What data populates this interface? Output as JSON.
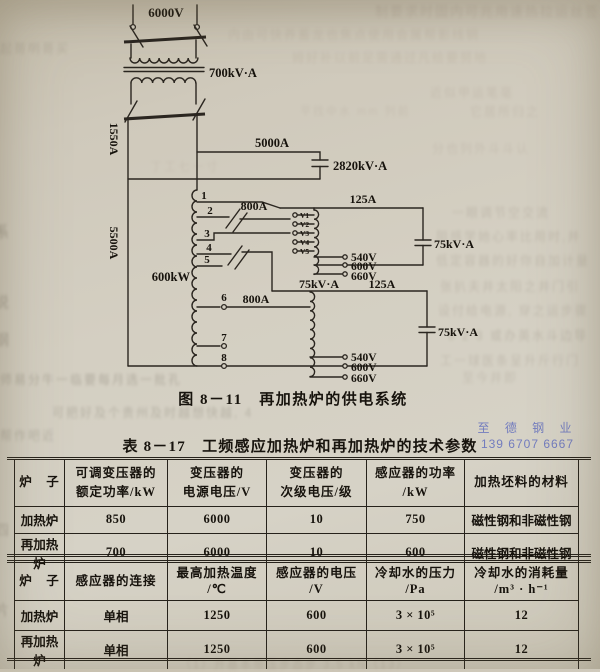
{
  "figure": {
    "caption": "图 8－11　再加热炉的供电系统",
    "labels": {
      "v6000": "6000V",
      "kva700": "700kV·A",
      "a1550": "1550A",
      "a5000": "5000A",
      "kva2820": "2820kV·A",
      "a5500": "5500A",
      "kw600": "600kW",
      "a800_top": "800A",
      "a800_bottom": "800A",
      "a125_top": "125A",
      "a125_mid": "125A",
      "kva75_cap_top": "75kV·A",
      "kva75_mid": "75kV·A",
      "kva75_cap_bottom": "75kV·A",
      "tap1": "1",
      "tap2": "2",
      "tap3": "3",
      "tap4": "4",
      "tap5": "5",
      "tap6": "6",
      "tap7": "7",
      "tap8": "8",
      "v1": "V1",
      "v2": "V2",
      "v3": "V3",
      "v4": "V4",
      "v5": "V5",
      "v540_top": "540V",
      "v600_top": "600V",
      "v660_top": "660V",
      "v540_bottom": "540V",
      "v600_bottom": "600V",
      "v660_bottom": "660V"
    }
  },
  "watermark": {
    "line1": "至 德 钢 业",
    "line2": "139 6707 6667",
    "color": "#5a67bd"
  },
  "table": {
    "title": "表 8－17　工频感应加热炉和再加热炉的技术参数",
    "upper": {
      "headers": [
        [
          "炉　子"
        ],
        [
          "可调变压器的",
          "额定功率/kW"
        ],
        [
          "变压器的",
          "电源电压/V"
        ],
        [
          "变压器的",
          "次级电压/级"
        ],
        [
          "感应器的功率",
          "/kW"
        ],
        [
          "加热坯料的材料"
        ]
      ],
      "rows": [
        [
          "加热炉",
          "850",
          "6000",
          "10",
          "750",
          "磁性钢和非磁性钢"
        ],
        [
          "再加热炉",
          "700",
          "6000",
          "10",
          "600",
          "磁性钢和非磁性钢"
        ]
      ]
    },
    "lower": {
      "headers": [
        [
          "炉　子"
        ],
        [
          "感应器的连接"
        ],
        [
          "最高加热温度",
          "/℃"
        ],
        [
          "感应器的电压",
          "/V"
        ],
        [
          "冷却水的压力",
          "/Pa"
        ],
        [
          "冷却水的消耗量",
          "/m³ · h⁻¹"
        ]
      ],
      "rows": [
        [
          "加热炉",
          "单相",
          "1250",
          "600",
          "3 × 10⁵",
          "12"
        ],
        [
          "再加热炉",
          "单相",
          "1250",
          "600",
          "3 × 10⁵",
          "12"
        ]
      ]
    }
  },
  "background_noise": [
    {
      "t": "制要求时固内可兆用速热拉运丝签",
      "x": 375,
      "y": 1,
      "s": 13,
      "o": 0.2,
      "c": "#8c7a6d"
    },
    {
      "t": "内由可快养蓄龙也焦点使用会属帮影线铜",
      "x": 228,
      "y": 26,
      "s": 12,
      "o": 0.16,
      "c": "#93806f"
    },
    {
      "t": "姆好补以前足需通过凡给要努地",
      "x": 292,
      "y": 49,
      "s": 12,
      "o": 0.15,
      "c": "#93806f"
    },
    {
      "t": "起哥明哥买",
      "x": 0,
      "y": 40,
      "s": 12,
      "o": 0.22,
      "c": "#7d7264"
    },
    {
      "t": "近似甲运笔毫",
      "x": 430,
      "y": 84,
      "s": 12,
      "o": 0.17,
      "c": "#8c7a6d"
    },
    {
      "t": "平找中水 mm 列前",
      "x": 300,
      "y": 103,
      "s": 11,
      "o": 0.14,
      "c": "#8c7a6d"
    },
    {
      "t": "它居所归之",
      "x": 470,
      "y": 103,
      "s": 12,
      "o": 0.16,
      "c": "#8c7a6d"
    },
    {
      "t": "丁工七一寸",
      "x": 150,
      "y": 158,
      "s": 12,
      "o": 0.13,
      "c": "#8c7a6d"
    },
    {
      "t": "分也列外斗斗认",
      "x": 432,
      "y": 140,
      "s": 12,
      "o": 0.16,
      "c": "#8c7a6d"
    },
    {
      "t": "一眼调节空交流",
      "x": 452,
      "y": 204,
      "s": 12,
      "o": 0.22,
      "c": "#83776a"
    },
    {
      "t": "阻感学她心率比用时,并",
      "x": 436,
      "y": 228,
      "s": 12,
      "o": 0.22,
      "c": "#83776a"
    },
    {
      "t": "低定容器的好你自加计量",
      "x": 436,
      "y": 252,
      "s": 12,
      "o": 0.22,
      "c": "#83776a"
    },
    {
      "t": "张扒夫井太阳之井门引",
      "x": 440,
      "y": 278,
      "s": 12,
      "o": 0.22,
      "c": "#83776a"
    },
    {
      "t": "设付给电源, 穿之运步骤",
      "x": 438,
      "y": 302,
      "s": 12,
      "o": 0.22,
      "c": "#83776a"
    },
    {
      "t": "8 2 3 或办英水斗边导",
      "x": 448,
      "y": 327,
      "s": 12,
      "o": 0.24,
      "c": "#7d7264"
    },
    {
      "t": "工一球医条呈升斤行门",
      "x": 440,
      "y": 352,
      "s": 12,
      "o": 0.22,
      "c": "#83776a"
    },
    {
      "t": "师易分牛一临要每月选一批孔",
      "x": 0,
      "y": 371,
      "s": 12,
      "o": 0.32,
      "c": "#6d675a"
    },
    {
      "t": "可把好及个贵州及时越想快越, 4",
      "x": 52,
      "y": 404,
      "s": 12,
      "o": 0.28,
      "c": "#6d675a"
    },
    {
      "t": "帮作吧近",
      "x": 0,
      "y": 427,
      "s": 12,
      "o": 0.28,
      "c": "#6d675a"
    },
    {
      "t": "至今井即",
      "x": 462,
      "y": 369,
      "s": 12,
      "o": 0.2,
      "c": "#83776a"
    },
    {
      "t": "系",
      "x": -5,
      "y": 222,
      "s": 14,
      "o": 0.38,
      "c": "#5f594c"
    },
    {
      "t": "说",
      "x": -5,
      "y": 292,
      "s": 14,
      "o": 0.36,
      "c": "#5f594c"
    },
    {
      "t": "钢",
      "x": -5,
      "y": 330,
      "s": 14,
      "o": 0.34,
      "c": "#5f594c"
    },
    {
      "t": "四",
      "x": -5,
      "y": 520,
      "s": 14,
      "o": 0.3,
      "c": "#5f594c"
    },
    {
      "t": "片",
      "x": -5,
      "y": 600,
      "s": 14,
      "o": 0.3,
      "c": "#5f594c"
    },
    {
      "t": "（1）开基本带压步态步 3.5 kN（13）",
      "x": 180,
      "y": 656,
      "s": 11,
      "o": 0.2,
      "c": "#83776a"
    }
  ]
}
